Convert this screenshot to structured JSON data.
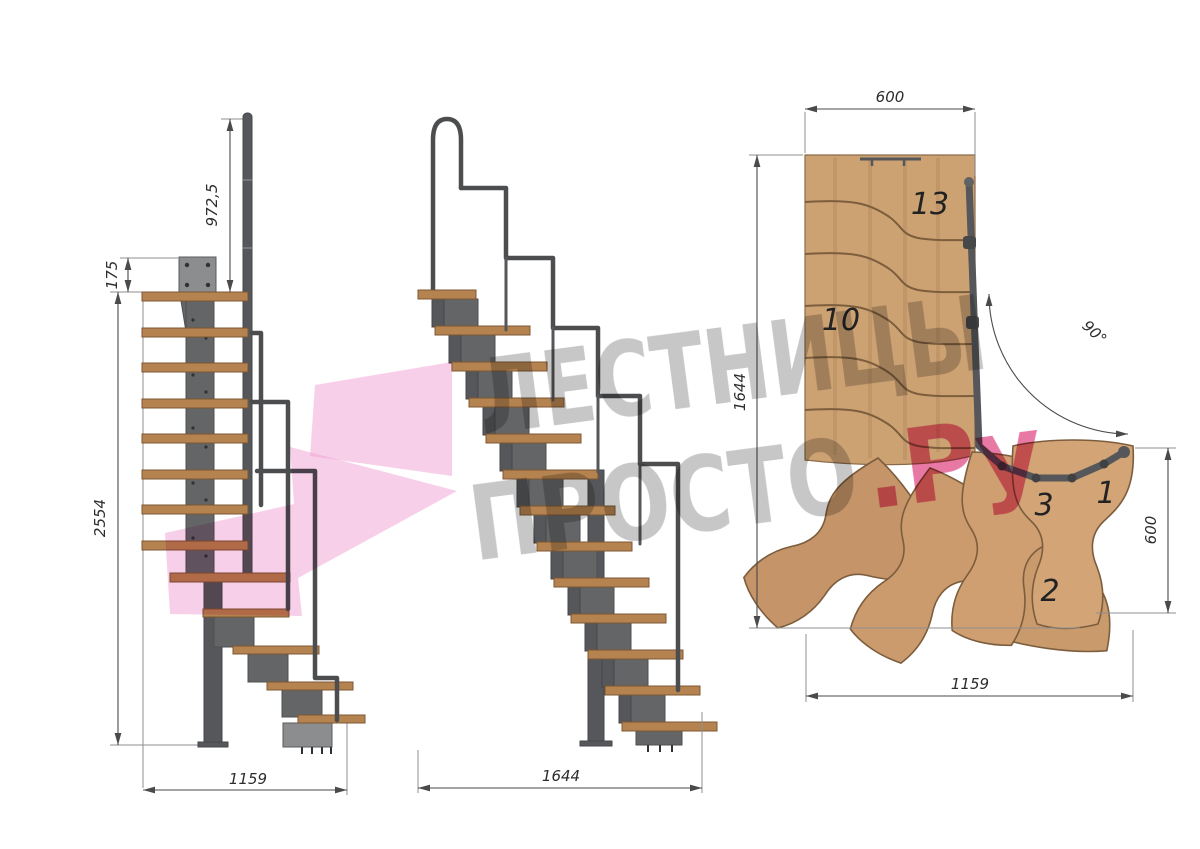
{
  "watermark": {
    "line1": "ЛЕСТНИЦЫ",
    "line2_gray": "ПРОСТО",
    "line2_pink": ".Ру",
    "text_color": "#9a9a9a",
    "pink_color": "#e2538c",
    "arrow_color": "#f29fd4"
  },
  "side_view": {
    "dim_rail_height": "972,5",
    "dim_plate_offset": "175",
    "dim_total_height": "2554",
    "dim_footprint": "1159"
  },
  "front_view": {
    "dim_width": "1644"
  },
  "plan_view": {
    "dim_top_width": "600",
    "dim_left_depth": "1644",
    "dim_turn_angle": "90°",
    "dim_right_depth": "600",
    "dim_bottom_width": "1159",
    "step_labels": [
      "13",
      "10",
      "3",
      "1",
      "2"
    ]
  },
  "colors": {
    "tread_wood": "#b5834f",
    "plan_wood": "#cda273",
    "metal": "#5f6062",
    "dimension_line": "#4a4a4a"
  }
}
